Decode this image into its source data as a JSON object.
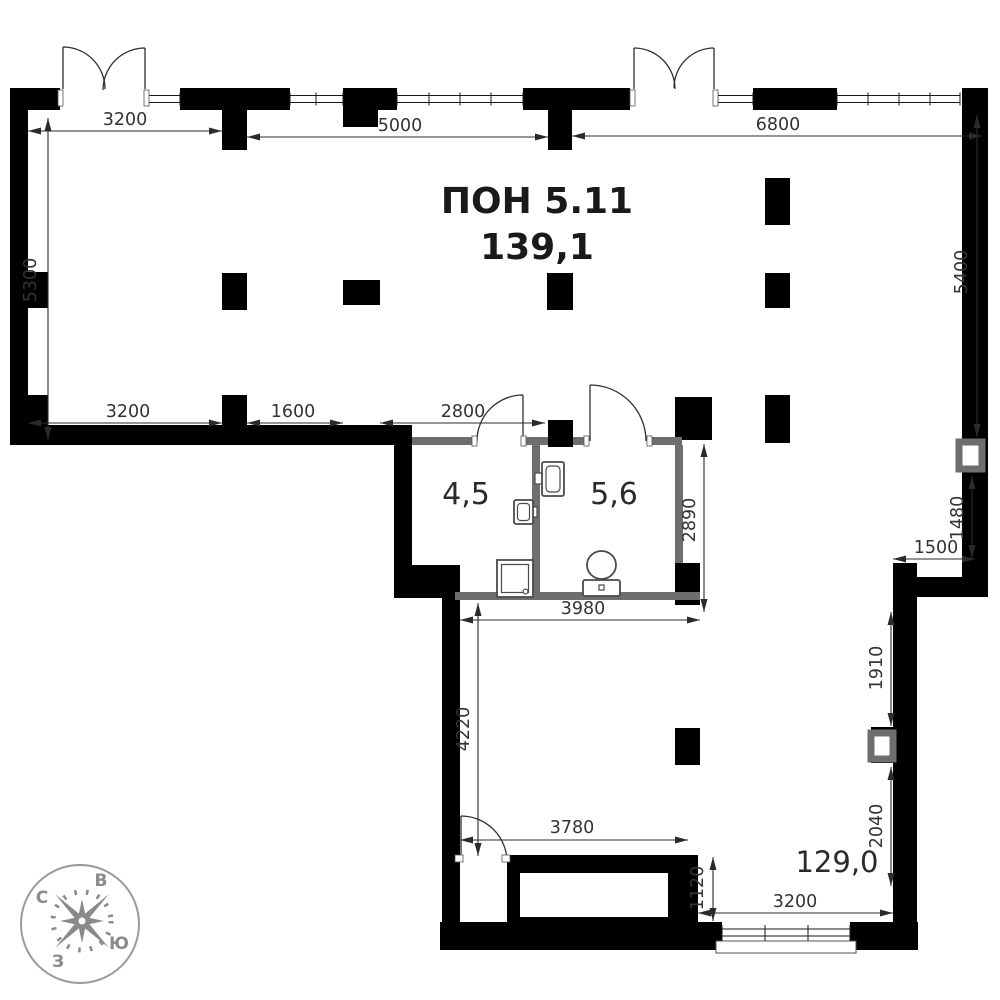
{
  "plan": {
    "title": "ПОН 5.11",
    "area": "139,1",
    "rooms": {
      "wc_small": "4,5",
      "wc_large": "5,6",
      "main": "129,0"
    },
    "dims": {
      "top_3200": "3200",
      "top_5000": "5000",
      "top_6800": "6800",
      "left_5300": "5300",
      "right_5400": "5400",
      "right_1480": "1480",
      "right_1500": "1500",
      "right_1910": "1910",
      "right_2040": "2040",
      "mid_3200": "3200",
      "mid_1600": "1600",
      "mid_2800": "2800",
      "wc_2890": "2890",
      "wc_3980": "3980",
      "low_4220": "4220",
      "low_3780": "3780",
      "low_1120": "1120",
      "low_3200": "3200"
    },
    "compass": {
      "north": "С",
      "east": "В",
      "south": "Ю",
      "west": "З"
    },
    "colors": {
      "wall": "#000000",
      "partition": "#6e6e6e",
      "dimension_text": "#333333",
      "compass": "#8a8a8a"
    }
  }
}
